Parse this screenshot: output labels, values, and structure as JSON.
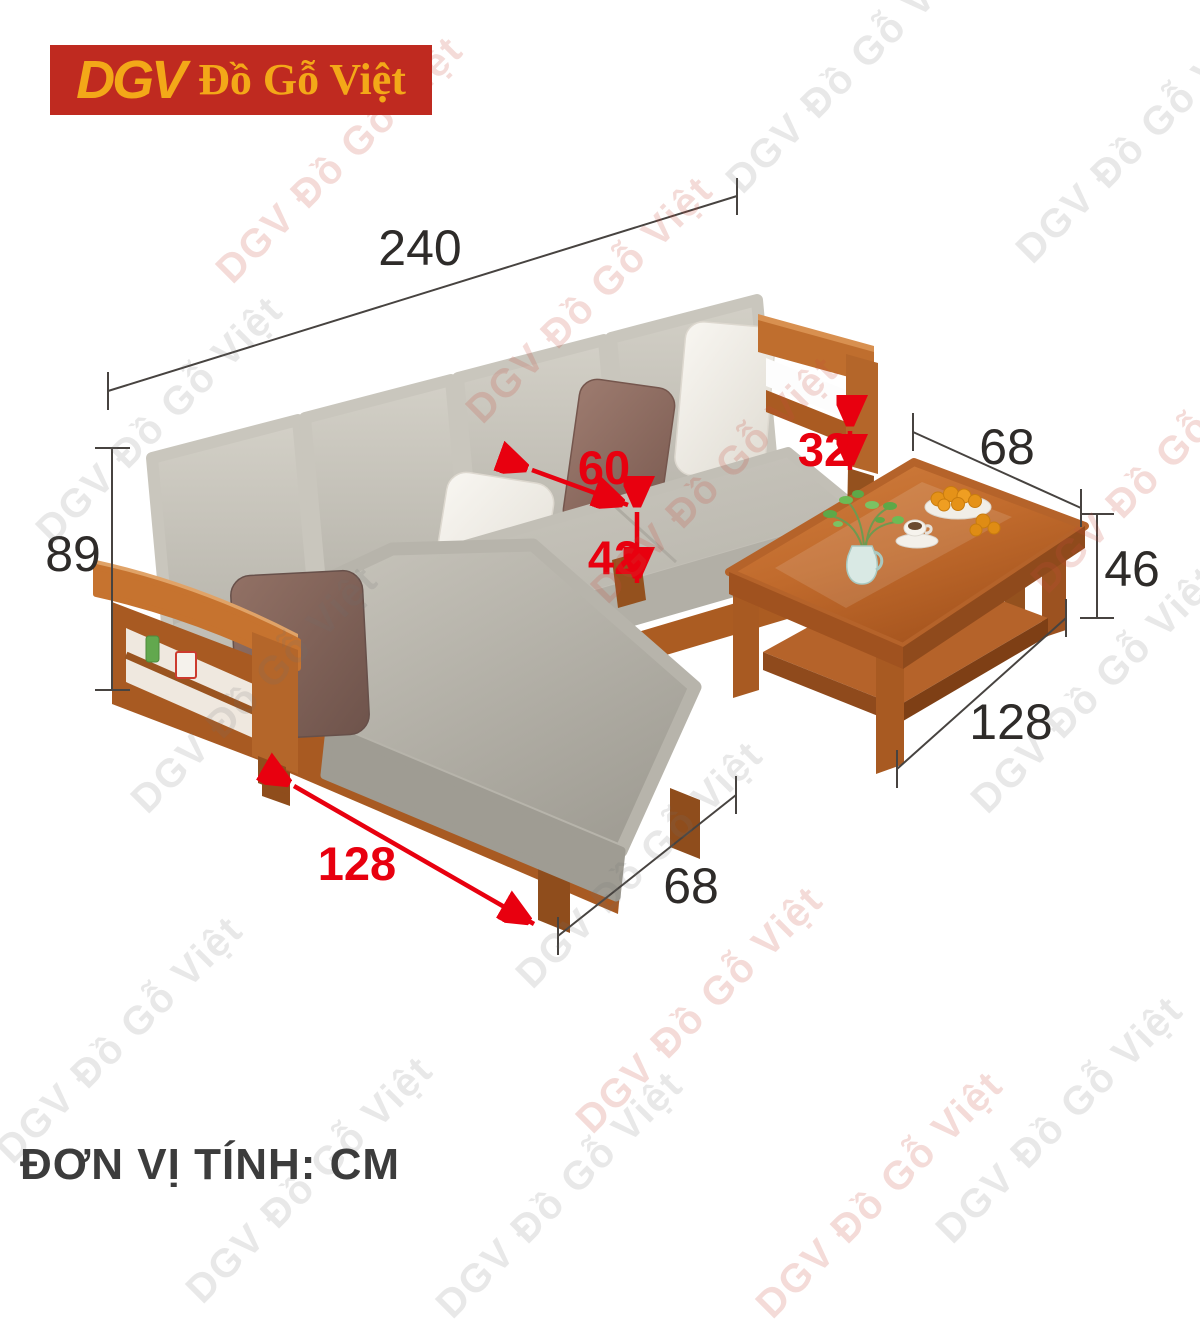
{
  "brand": {
    "logo_acronym": "DGV",
    "logo_name": "Đồ Gỗ Việt",
    "watermark_text": "DGV Đồ Gỗ Việt",
    "logo_bg_color": "#bf2a20",
    "logo_text_color": "#f3a818"
  },
  "footer": {
    "unit_note": "ĐƠN VỊ TÍNH: CM"
  },
  "dimensions": {
    "unit": "CM",
    "sofa": {
      "width": "240",
      "height": "89",
      "seat_depth": "60",
      "seat_height": "42",
      "cushion_thickness": "32",
      "chaise_length": "128",
      "chaise_width": "68"
    },
    "table": {
      "width": "68",
      "height": "46",
      "length": "128"
    }
  },
  "colors": {
    "dimension_red": "#e8000f",
    "dimension_black": "#474340",
    "wood": "#b4662a",
    "cushion_gray": "#c5c2b9"
  }
}
